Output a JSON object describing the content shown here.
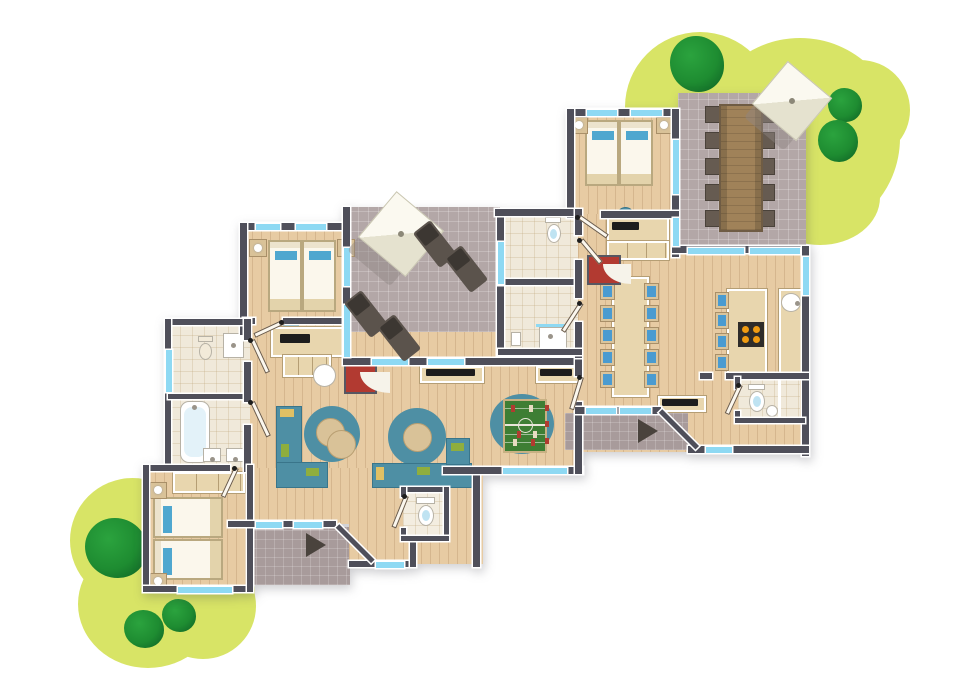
{
  "scene": {
    "title": "Holiday lodge floor plan (top-down illustration)",
    "type": "architectural floor plan, no visible text",
    "units": 2,
    "entrance_arrows": 2
  },
  "palette": {
    "background": "#ffffff",
    "wall": "#4f4f5a",
    "window_glass": "#8ed9f3",
    "wood_floor": "#e7cba3",
    "bath_floor": "#f0e9da",
    "terrace_tile": "#b3a7a7",
    "porch_tile": "#a89b9b",
    "bush_green": "#d8e466",
    "tree_green": "#1e8c31",
    "sofa_teal": "#4e8fa4",
    "pouf_tan": "#d9c298",
    "pillow_blue": "#4fa7cf",
    "chair_cushion_blue": "#4a9bd0",
    "fireplace_red": "#b23a31",
    "foosball_green": "#3e7e34",
    "lounger_gray": "#5b534c",
    "umbrella_ivory": "#f4f1e1",
    "outdoor_table_wood": "#a08259",
    "stove_black": "#2e2c2a",
    "burner_orange": "#ef9b12"
  },
  "left_lodge": {
    "rooms": [
      {
        "name": "twin-bedroom-north",
        "furniture": [
          "double bed (2 singles)",
          "2 nightstands with lamps",
          "desk with TV",
          "stool"
        ]
      },
      {
        "name": "bathroom-wc",
        "furniture": [
          "toilet",
          "shower tray"
        ]
      },
      {
        "name": "bathroom-bathtub",
        "furniture": [
          "bathtub",
          "2 washbasins"
        ]
      },
      {
        "name": "twin-bedroom-southwest",
        "furniture": [
          "2 single beds",
          "2 nightstands with lamps",
          "wardrobe"
        ]
      },
      {
        "name": "living-room",
        "furniture": [
          "2 corner sofas",
          "2 round lounge rugs with poufs",
          "round table",
          "wall TV",
          "fireplace",
          "foosball table on round rug"
        ]
      },
      {
        "name": "wc",
        "furniture": [
          "toilet"
        ]
      },
      {
        "name": "entrance-porch",
        "furniture": [
          "entrance arrow"
        ]
      }
    ]
  },
  "right_lodge": {
    "rooms": [
      {
        "name": "twin-bedroom-north",
        "furniture": [
          "2 single beds",
          "2 nightstands with lamps",
          "desk with TV",
          "stool"
        ]
      },
      {
        "name": "wc-room",
        "furniture": [
          "toilet"
        ]
      },
      {
        "name": "shower-room",
        "furniture": [
          "shower",
          "washbasin"
        ]
      },
      {
        "name": "dining-room",
        "furniture": [
          "long table",
          "10 chairs",
          "fireplace",
          "wall TV"
        ]
      },
      {
        "name": "kitchen",
        "furniture": [
          "island with hob",
          "4 bar stools",
          "counter with sink"
        ]
      },
      {
        "name": "bathroom-southeast",
        "furniture": [
          "toilet",
          "washbasin"
        ]
      },
      {
        "name": "entrance-porch",
        "furniture": [
          "entrance arrow"
        ]
      }
    ]
  },
  "outdoor": {
    "central_terrace": [
      "parasol",
      "4 sun loungers"
    ],
    "upper_terrace": [
      "parasol",
      "long dining table",
      "10 chairs"
    ],
    "landscaping": [
      "yellow-green shrub clusters top-right and bottom-left",
      "3 trees top-right",
      "3 trees bottom-left"
    ]
  }
}
